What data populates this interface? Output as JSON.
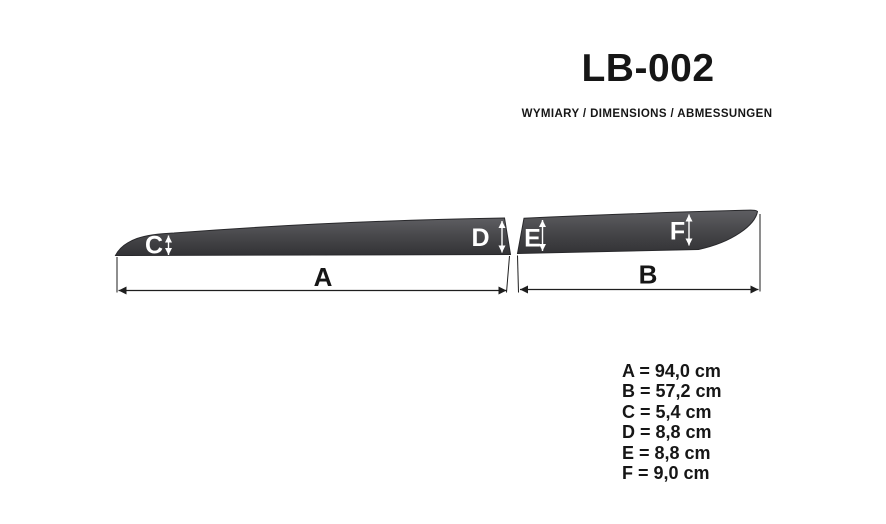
{
  "header": {
    "title": "LB-002",
    "subtitle": "WYMIARY / DIMENSIONS / ABMESSUNGEN"
  },
  "diagram": {
    "labels": {
      "a": "A",
      "b": "B",
      "c": "C",
      "d": "D",
      "e": "E",
      "f": "F"
    }
  },
  "dimensions": {
    "unit": "cm",
    "items": [
      {
        "label": "A",
        "value": "94,0",
        "unit": "cm",
        "text": "A = 94,0 cm"
      },
      {
        "label": "B",
        "value": "57,2",
        "unit": "cm",
        "text": "B = 57,2 cm"
      },
      {
        "label": "C",
        "value": "5,4",
        "unit": "cm",
        "text": "C = 5,4 cm"
      },
      {
        "label": "D",
        "value": "8,8",
        "unit": "cm",
        "text": "D = 8,8 cm"
      },
      {
        "label": "E",
        "value": "8,8",
        "unit": "cm",
        "text": "E = 8,8 cm"
      },
      {
        "label": "F",
        "value": "9,0",
        "unit": "cm",
        "text": "F = 9,0 cm"
      }
    ]
  },
  "colors": {
    "background": "#ffffff",
    "blade_top": "#5e5e62",
    "blade_mid": "#49494c",
    "blade_bottom": "#323235",
    "blade_outline": "#28282b",
    "blade_label": "#ffffff",
    "dimension_line": "#1e1e1e",
    "text": "#161616"
  }
}
